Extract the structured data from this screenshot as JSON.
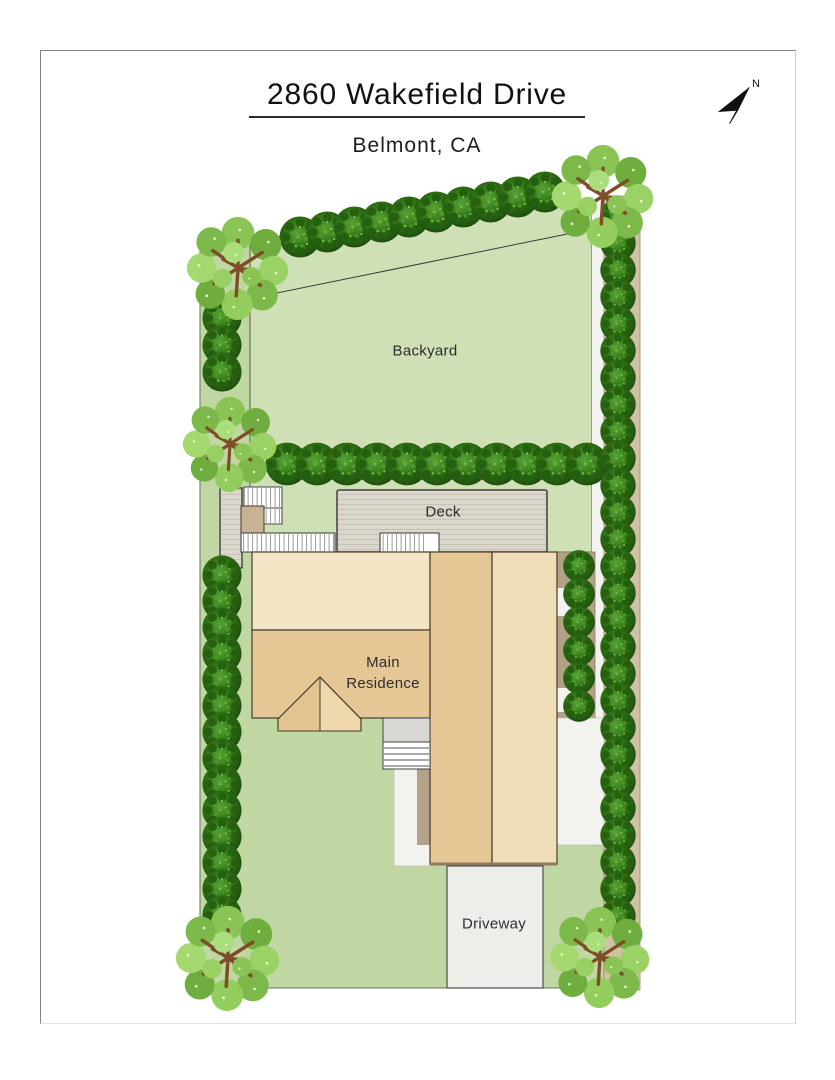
{
  "header": {
    "title": "2860 Wakefield Drive",
    "subtitle": "Belmont, CA"
  },
  "compass": {
    "north_label": "N"
  },
  "areas": {
    "backyard_label": "Backyard",
    "deck_label": "Deck",
    "main_residence_label": "Main\nResidence",
    "driveway_label": "Driveway"
  },
  "colors": {
    "page_bg": "#ffffff",
    "lawn_green": "#c1d7a3",
    "backyard_green": "#cfe0b6",
    "deck_gray": "#dbd7cd",
    "house_light_tan": "#f3e6c6",
    "house_tan": "#e4c794",
    "house_pale_tan": "#efddb7",
    "gable_light": "#eed7ab",
    "gable_dark": "#e3c58f",
    "landing_tan": "#c8b294",
    "driveway_gray": "#ededea",
    "walkway_white": "#f2f2ef",
    "boundary_tan": "#cfc2a4",
    "side_khaki": "#b2a185",
    "bush_dark_green": "#2c6a17",
    "tree_green": "#8ac455",
    "outline_dark": "#463c2e"
  }
}
